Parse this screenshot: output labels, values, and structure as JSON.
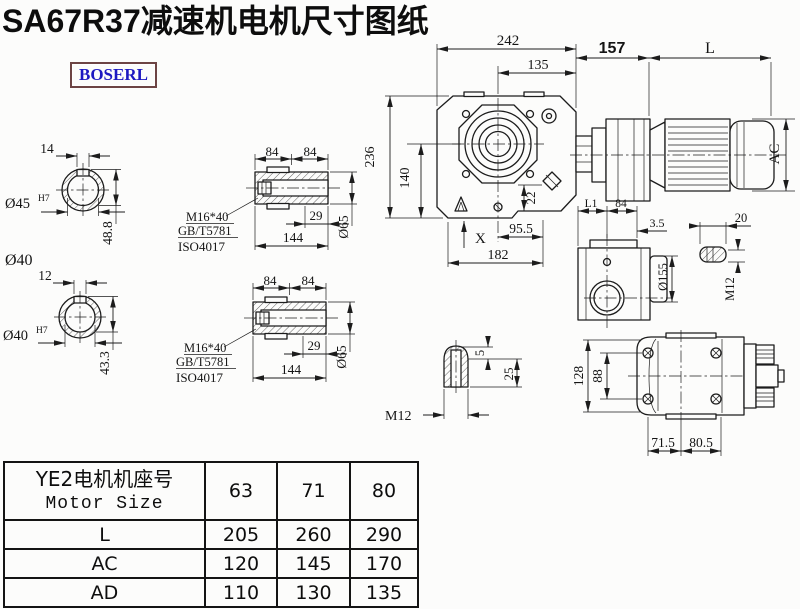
{
  "title": "SA67R37减速机电机尺寸图纸",
  "logo": "BOSERL",
  "colors": {
    "line": "#1c1c1c",
    "logo_text": "#1d18c1",
    "logo_border": "#6d4444",
    "title": "#0d0d0d"
  },
  "views": {
    "shaft_end_top": {
      "keyway_width": "14",
      "bore_dia": "Ø45",
      "bore_tol": "H7",
      "keyway_depth": "48.8",
      "shaft_dia_label": "Ø40"
    },
    "shaft_end_bottom": {
      "keyway_width": "12",
      "bore_dia": "Ø40",
      "bore_tol": "H7",
      "keyway_depth": "43.3"
    },
    "hollow_shaft_top": {
      "dim_84_left": "84",
      "dim_84_right": "84",
      "bolt_spec": "M16*40",
      "standard_1": "GB/T5781",
      "standard_2": "ISO4017",
      "dim_29": "29",
      "dim_144": "144",
      "dim_dia65": "Ø65"
    },
    "hollow_shaft_bottom": {
      "dim_84_left": "84",
      "dim_84_right": "84",
      "bolt_spec": "M16*40",
      "standard_1": "GB/T5781",
      "standard_2": "ISO4017",
      "dim_29": "29",
      "dim_144": "144",
      "dim_dia65": "Ø65"
    },
    "front_view": {
      "dim_242": "242",
      "dim_135": "135",
      "dim_157": "157",
      "dim_L": "L",
      "dim_236": "236",
      "dim_140": "140",
      "dim_22": "22",
      "dim_AC": "AC",
      "dim_X": "X",
      "dim_95_5": "95.5",
      "dim_182": "182"
    },
    "side_view": {
      "dim_L1": "L1",
      "dim_84": "84",
      "dim_3_5": "3.5",
      "dim_20": "20",
      "dim_dia155": "Ø155",
      "dim_M12": "M12"
    },
    "keyway_detail": {
      "dim_5": "5",
      "dim_25": "25",
      "dim_M12": "M12"
    },
    "bottom_view": {
      "dim_128": "128",
      "dim_88": "88",
      "dim_71_5": "71.5",
      "dim_80_5": "80.5"
    }
  },
  "table": {
    "header_cn": "YE2电机机座号",
    "header_en": "Motor Size",
    "motor_sizes": [
      "63",
      "71",
      "80"
    ],
    "rows": [
      {
        "label": "L",
        "values": [
          "205",
          "260",
          "290"
        ]
      },
      {
        "label": "AC",
        "values": [
          "120",
          "145",
          "170"
        ]
      },
      {
        "label": "AD",
        "values": [
          "110",
          "130",
          "135"
        ]
      }
    ]
  }
}
